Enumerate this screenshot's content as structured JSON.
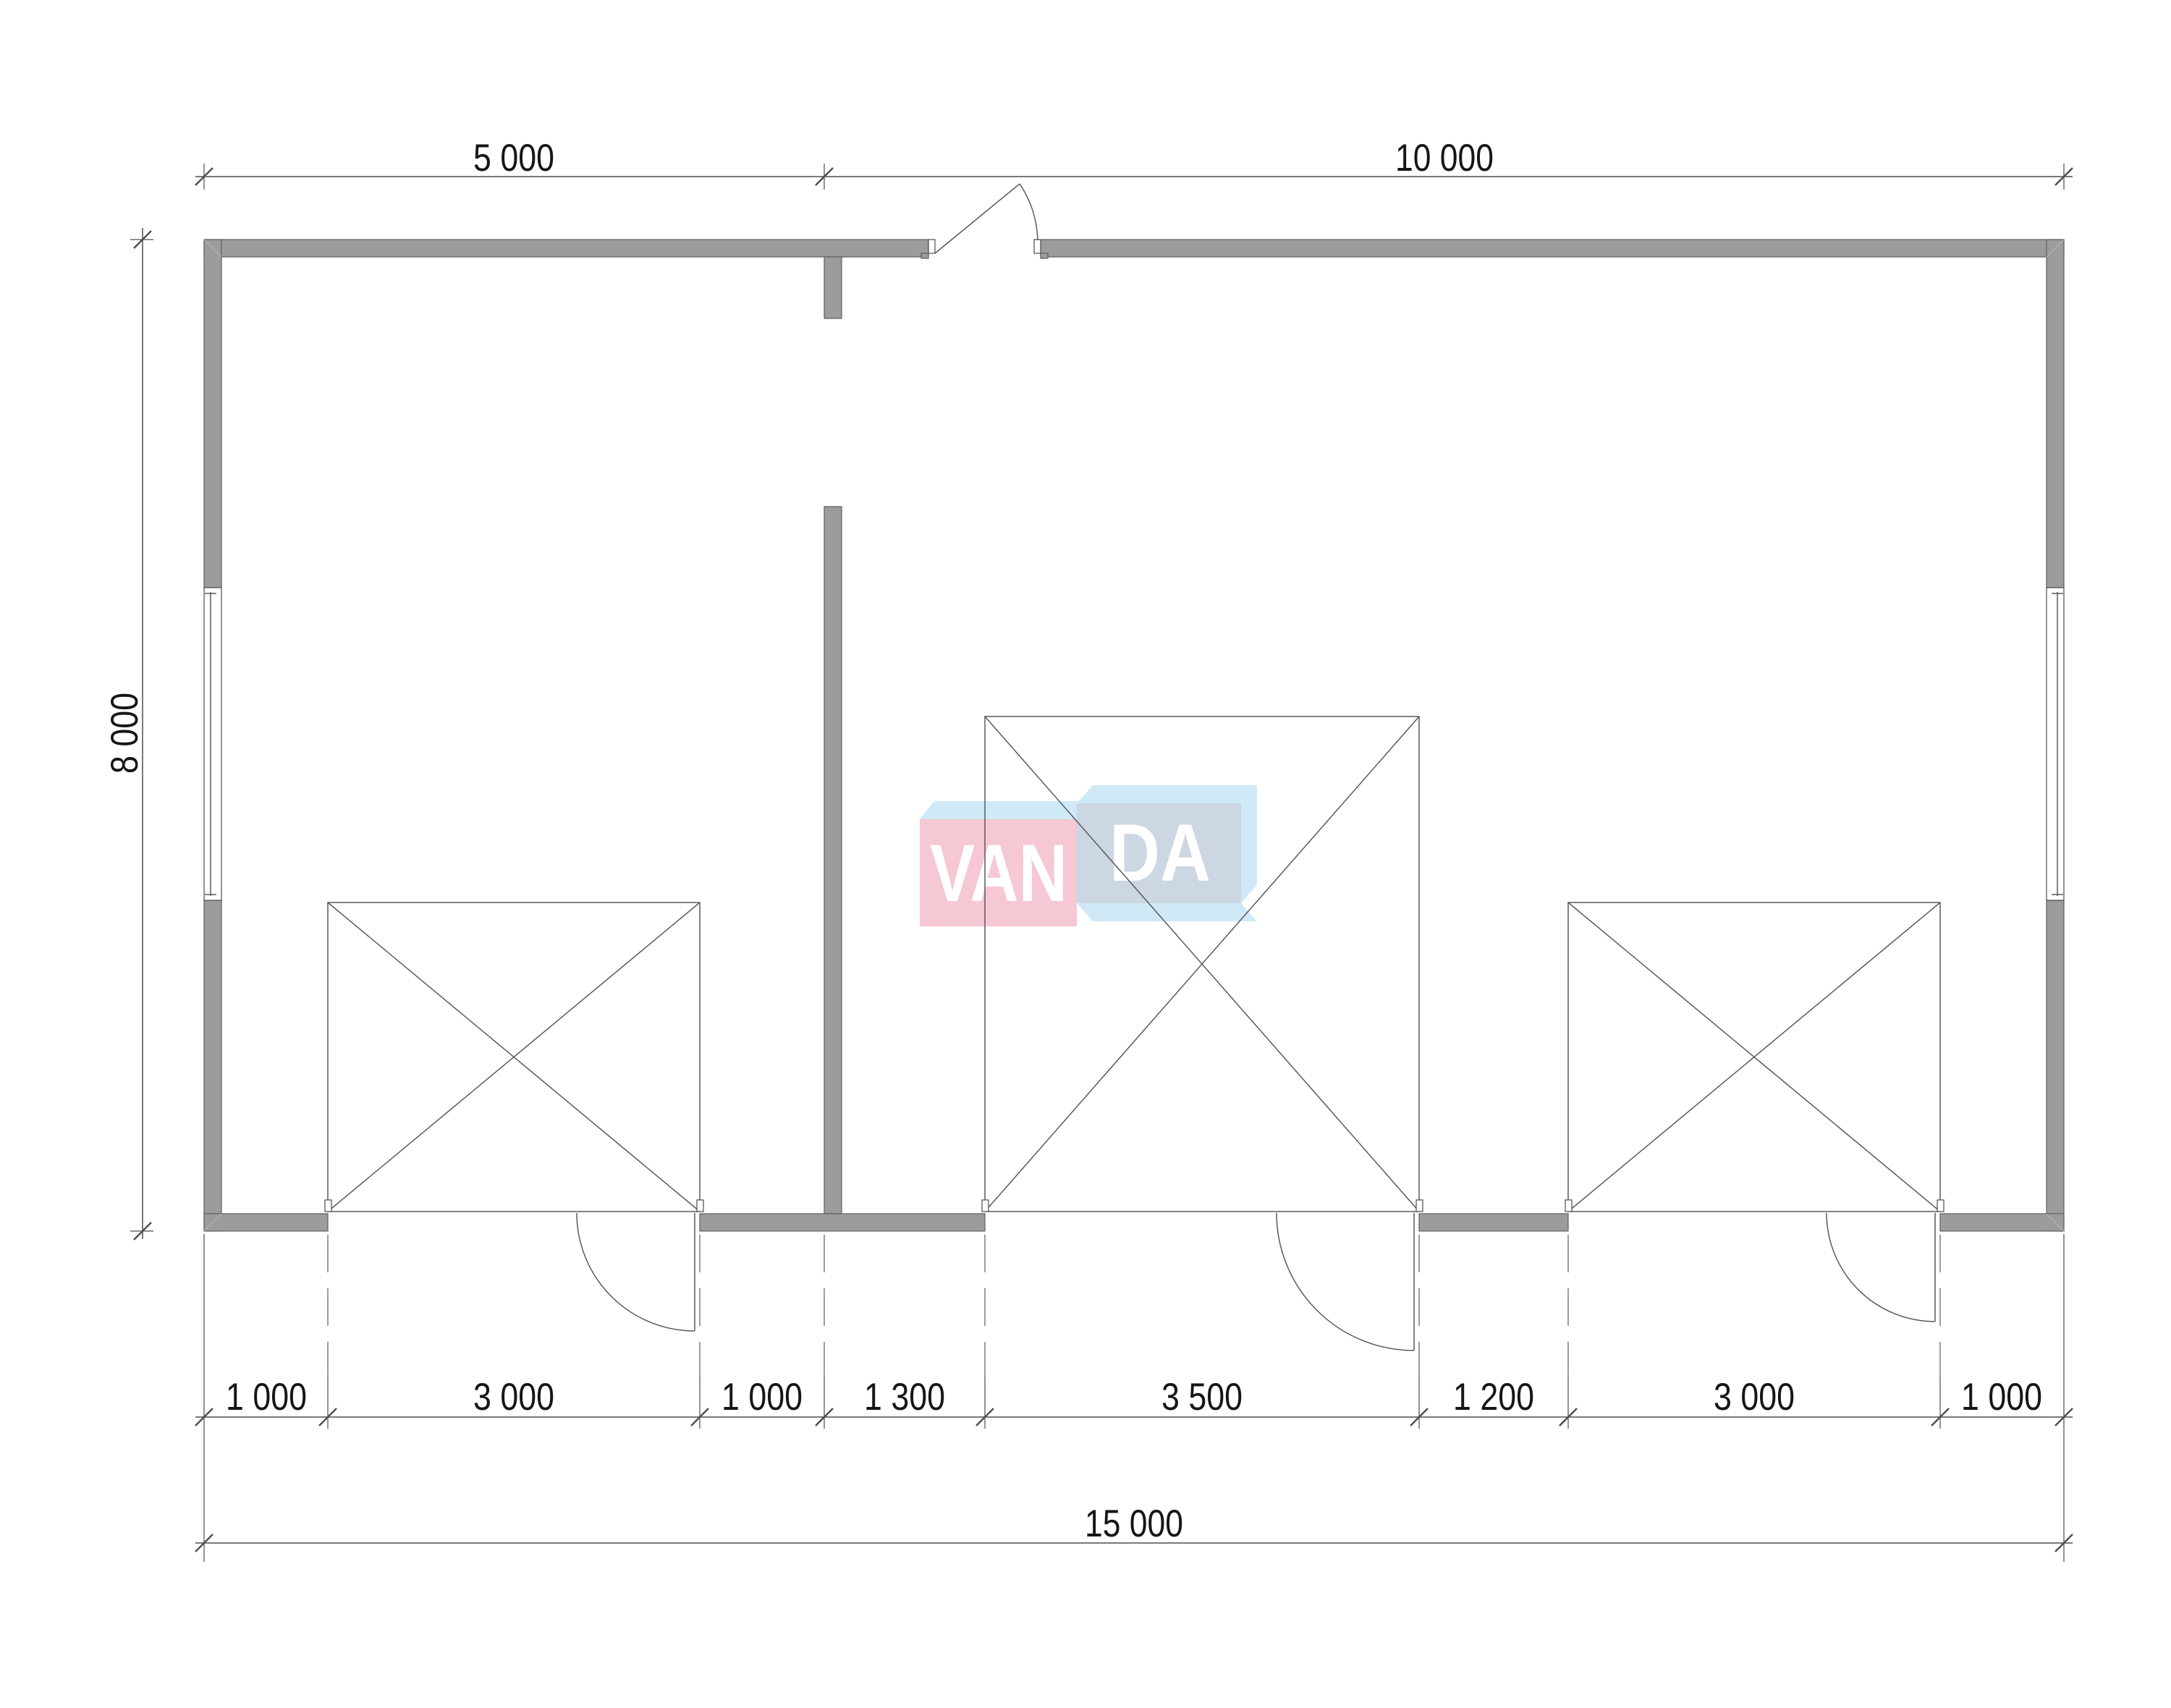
{
  "drawing": {
    "type": "architectural-floor-plan",
    "building": {
      "width_label": "15 000",
      "height_label": "8 000"
    },
    "colors": {
      "wall_gray": "#9c9c9c",
      "line_dark": "#4d4d4d",
      "logo_red_box": "#f5c8d3",
      "logo_blue_face": "#cfe9f7",
      "logo_blue_box": "#ccd7e3",
      "logo_letters": "#ffffff"
    }
  },
  "watermark": {
    "van": "VAN",
    "da": "DA"
  },
  "dimensions": {
    "top": [
      {
        "label": "5 000"
      },
      {
        "label": "10 000"
      }
    ],
    "side": [
      {
        "label": "8 000"
      }
    ],
    "bottom_segments": [
      {
        "label": "1 000"
      },
      {
        "label": "3 000"
      },
      {
        "label": "1 000"
      },
      {
        "label": "1 300"
      },
      {
        "label": "3 500"
      },
      {
        "label": "1 200"
      },
      {
        "label": "3 000"
      },
      {
        "label": "1 000"
      }
    ],
    "bottom_total": [
      {
        "label": "15 000"
      }
    ]
  }
}
